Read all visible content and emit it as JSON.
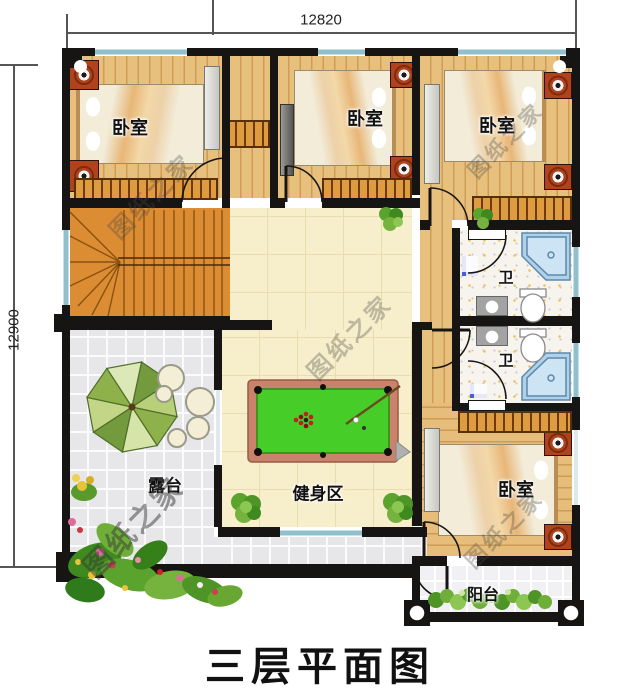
{
  "title": "三层平面图",
  "watermark": "图纸之家",
  "dimensions": {
    "width": "12820",
    "height": "12900"
  },
  "rooms": {
    "bedroom_top_left": "卧室",
    "bedroom_top_middle": "卧室",
    "bedroom_top_right": "卧室",
    "bedroom_bottom_right": "卧室",
    "bathroom_upper": "卫",
    "bathroom_lower": "卫",
    "terrace": "露台",
    "gym": "健身区",
    "balcony": "阳台"
  },
  "colors": {
    "wall": "#171513",
    "window": "#8fc0cc",
    "hall": "#f7eecb",
    "stairs": "#dc8d33",
    "pool_felt": "#46cd28",
    "pool_rail": "#c9826b"
  }
}
